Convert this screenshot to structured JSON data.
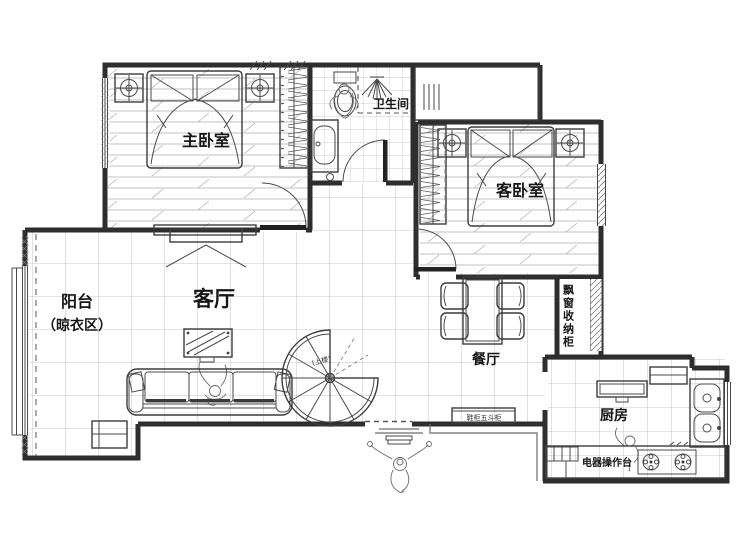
{
  "rooms": {
    "master_bedroom": {
      "label": "主卧室"
    },
    "bathroom": {
      "label": "卫生间"
    },
    "guest_bedroom": {
      "label": "客卧室"
    },
    "balcony": {
      "label": "阳台",
      "sublabel": "（晾衣区）"
    },
    "living_room": {
      "label": "客厅"
    },
    "dining_room": {
      "label": "餐厅"
    },
    "kitchen": {
      "label": "厨房"
    }
  },
  "annotations": {
    "appliance_counter": "电器操作台",
    "bay_window_cabinet": "飘窗收纳柜",
    "stairs_up": "(上楼)",
    "entry_cabinet": "鞋柜五斗柜"
  },
  "colors": {
    "wall": "#2e2e2e",
    "line": "#4a4a4a",
    "floor_line": "#b5b5b5",
    "background": "#ffffff"
  }
}
